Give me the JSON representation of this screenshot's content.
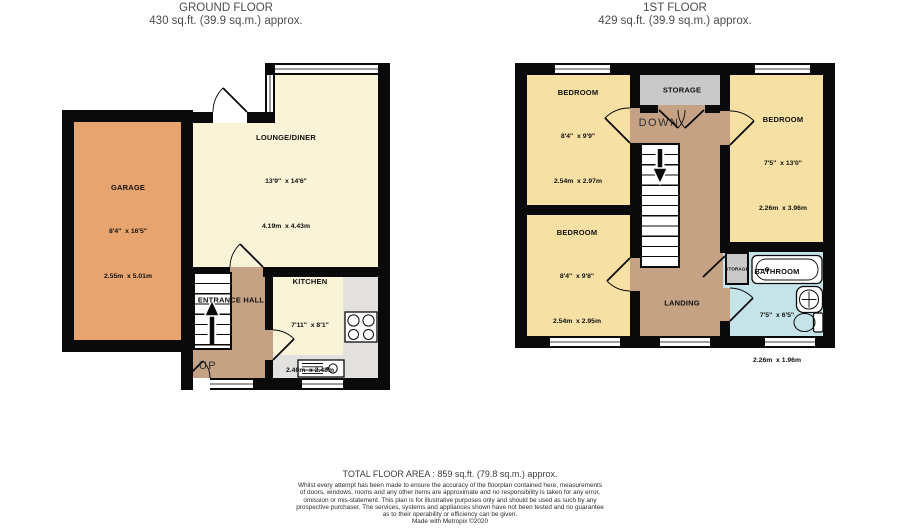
{
  "ground_floor": {
    "title": "GROUND FLOOR",
    "subtitle": "430 sq.ft. (39.9 sq.m.) approx.",
    "rooms": {
      "garage": {
        "name": "GARAGE",
        "imperial": "8'4\"  x 16'5\"",
        "metric": "2.55m  x 5.01m"
      },
      "lounge_diner": {
        "name": "LOUNGE/DINER",
        "imperial": "13'9\"  x 14'6\"",
        "metric": "4.19m  x 4.43m"
      },
      "entrance_hall": {
        "name": "ENTRANCE HALL"
      },
      "kitchen": {
        "name": "KITCHEN",
        "imperial": "7'11\"  x 8'1\"",
        "metric": "2.40m  x 2.48m"
      }
    },
    "labels": {
      "up": "UP"
    }
  },
  "first_floor": {
    "title": "1ST FLOOR",
    "subtitle": "429 sq.ft. (39.9 sq.m.) approx.",
    "rooms": {
      "bedroom_top_left": {
        "name": "BEDROOM",
        "imperial": "8'4\"  x 9'9\"",
        "metric": "2.54m  x 2.97m"
      },
      "bedroom_top_right": {
        "name": "BEDROOM",
        "imperial": "7'5\"  x 13'0\"",
        "metric": "2.26m  x 3.96m"
      },
      "bedroom_bot_left": {
        "name": "BEDROOM",
        "imperial": "8'4\"  x 9'8\"",
        "metric": "2.54m  x 2.95m"
      },
      "bathroom": {
        "name": "BATHROOM",
        "imperial": "7'5\"  x 6'5\"",
        "metric": "2.26m  x 1.96m"
      },
      "storage_top": {
        "name": "STORAGE"
      },
      "storage_small": {
        "name": "STORAGE"
      },
      "landing": {
        "name": "LANDING"
      }
    },
    "labels": {
      "down": "DOWN"
    }
  },
  "footer": {
    "total": "TOTAL FLOOR AREA : 859 sq.ft. (79.8 sq.m.) approx.",
    "disclaimer_lines": [
      "Whilst every attempt has been made to ensure the accuracy of the floorplan contained here, measurements",
      "of doors, windows, rooms and any other items are approximate and no responsibility is taken for any error,",
      "omission or mis-statement. This plan is for illustrative purposes only and should be used as such by any",
      "prospective purchaser. The services, systems and appliances shown have not been tested and no guarantee",
      "as to their operability or efficiency can be given."
    ],
    "credit": "Made with Metropix ©2020"
  },
  "colors": {
    "wall": "#0a0a0a",
    "garage": "#e8a46e",
    "living_cream": "#f9f3d8",
    "bedroom_yellow": "#f6e0a3",
    "hall_brown": "#c6a284",
    "bathroom_blue": "#c4e4ea",
    "storage_gray": "#c9c9c9",
    "kitchen_floor_gray": "#e2e1df"
  }
}
